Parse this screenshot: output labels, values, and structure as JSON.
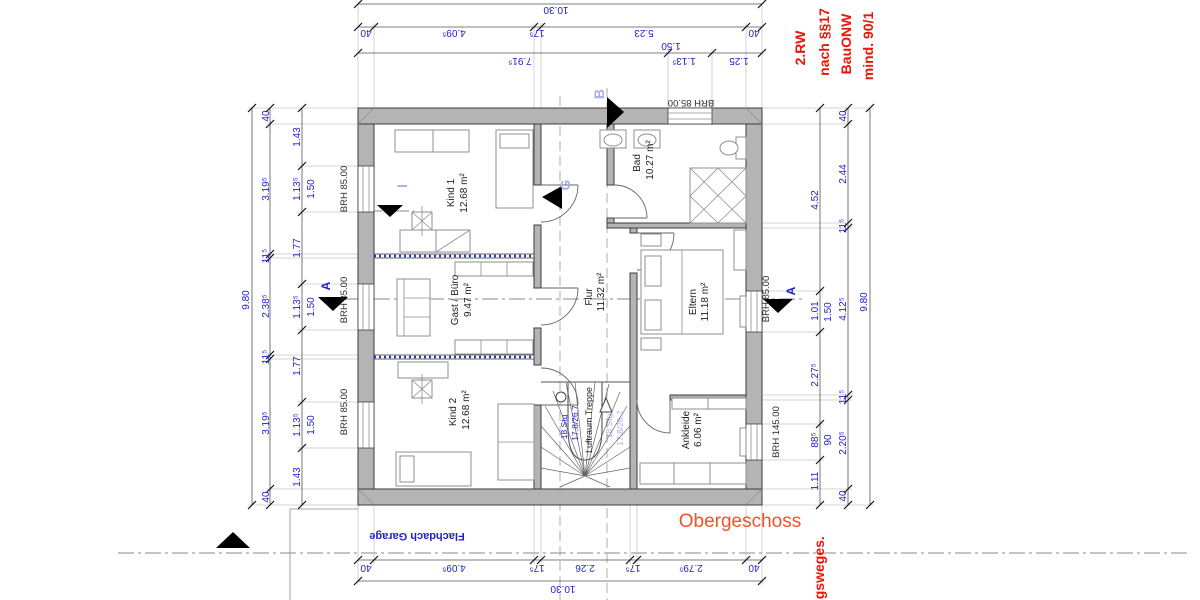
{
  "plan": {
    "floor_label": "Obergeschoss",
    "garage_label": "Flachdach Garage",
    "rooms": {
      "kind1": {
        "name": "Kind 1",
        "area": "12.68 m²"
      },
      "bad": {
        "name": "Bad",
        "area": "10.27 m²"
      },
      "gast": {
        "name": "Gast / Büro",
        "area": "9.47 m²"
      },
      "flur": {
        "name": "Flur",
        "area": "11.32 m²"
      },
      "eltern": {
        "name": "Eltern",
        "area": "11.18 m²"
      },
      "kind2": {
        "name": "Kind 2",
        "area": "12.68 m²"
      },
      "ankleide": {
        "name": "Ankleide",
        "area": "6.06 m²"
      },
      "treppe": {
        "name": "Luftraum Treppe"
      }
    },
    "stairs": {
      "count": "18 Stg",
      "rise_run": "17.8/26.7"
    },
    "sills": {
      "brh85": "BRH 85.00",
      "brh145": "BRH 145.00"
    },
    "markers": {
      "a": "A",
      "b": "B",
      "g": "G",
      "i": "I"
    }
  },
  "annotations": {
    "rescue_window": [
      "2.RW",
      "nach §§17",
      "BauONW",
      "mind. 90/1"
    ],
    "escape_route_fragment": "ngsweges."
  },
  "dimensions": {
    "top_total": "10.30",
    "top_chain": [
      "40",
      "4.09⁵",
      "17⁵",
      "5.23",
      "40"
    ],
    "top_inner": [
      "7.91⁵",
      "1.13⁵",
      "1.25"
    ],
    "top_window": "1.50",
    "bottom_chain": [
      "40",
      "4.09⁵",
      "17⁵",
      "2.26",
      "17⁵",
      "2.79⁵",
      "40"
    ],
    "bottom_total": "10.30",
    "left_total": "9.80",
    "left_chain": [
      "40",
      "3.19⁵",
      "11⁵",
      "2.38⁵",
      "11⁵",
      "3.19⁵",
      "40"
    ],
    "left_inner": [
      "1.43",
      "1.13⁵",
      "1.77",
      "1.13⁵",
      "1.77",
      "1.13⁵",
      "1.43"
    ],
    "left_window": "1.50",
    "right_outer": [
      "4.52",
      "1.01",
      "2.27⁵",
      "88⁵",
      "1.11"
    ],
    "right_window_a": "1.50",
    "right_window_b": "90",
    "right_chain": [
      "40",
      "2.44",
      "11⁵",
      "4.12⁵",
      "11⁵",
      "2.20⁵",
      "40"
    ],
    "right_total": "9.80"
  }
}
